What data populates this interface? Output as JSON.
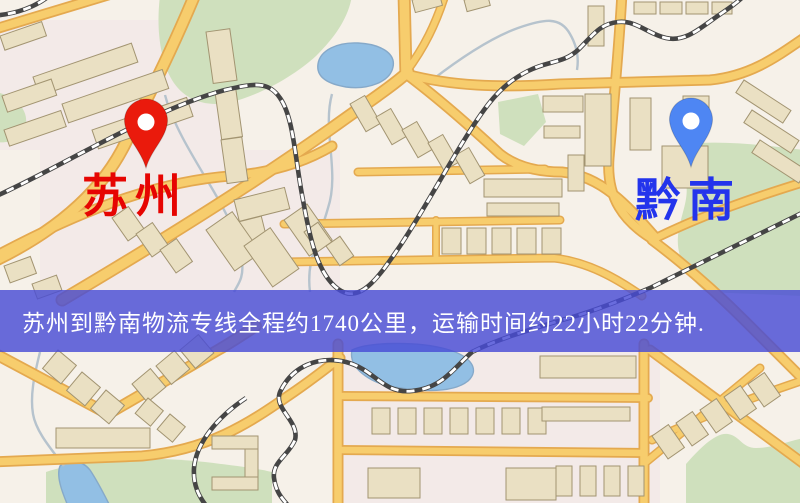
{
  "map": {
    "origin": {
      "label": "苏州",
      "pin": "red-map-pin",
      "label_color": "#e60502",
      "pin_color": "#ea1a0c"
    },
    "destination": {
      "label": "黔南",
      "pin": "blue-map-pin",
      "label_color": "#2334ec",
      "pin_color": "#4e86f3"
    }
  },
  "banner": {
    "text": "苏州到黔南物流专线全程约1740公里，运输时间约22小时22分钟.",
    "background": "rgba(72,76,213,0.82)",
    "text_color": "#ffffff"
  },
  "route_info": {
    "origin": "苏州",
    "destination": "黔南",
    "service": "物流专线",
    "distance_text": "约1740公里",
    "duration_text": "约22小时22分钟"
  },
  "palette": {
    "map-bg": "#f6f1e9",
    "tint": "#f0dfe7",
    "park": "#cfe0bd",
    "water": "#92bfe4",
    "water-line": "#86a9c9",
    "stream": "#b6c3cd",
    "road": "#f7cd6d",
    "road-edge": "#e4a94f",
    "rail": "#454545",
    "rail-dash": "#ffffff",
    "building": "#eae0c3",
    "building-line": "#a29471",
    "banner-bg": "rgba(72,76,213,0.82)",
    "banner-text": "#ffffff",
    "pin-origin": "#ea1a0c",
    "pin-dest": "#4e86f3",
    "label-origin": "#e60502",
    "label-dest": "#2334ec"
  }
}
